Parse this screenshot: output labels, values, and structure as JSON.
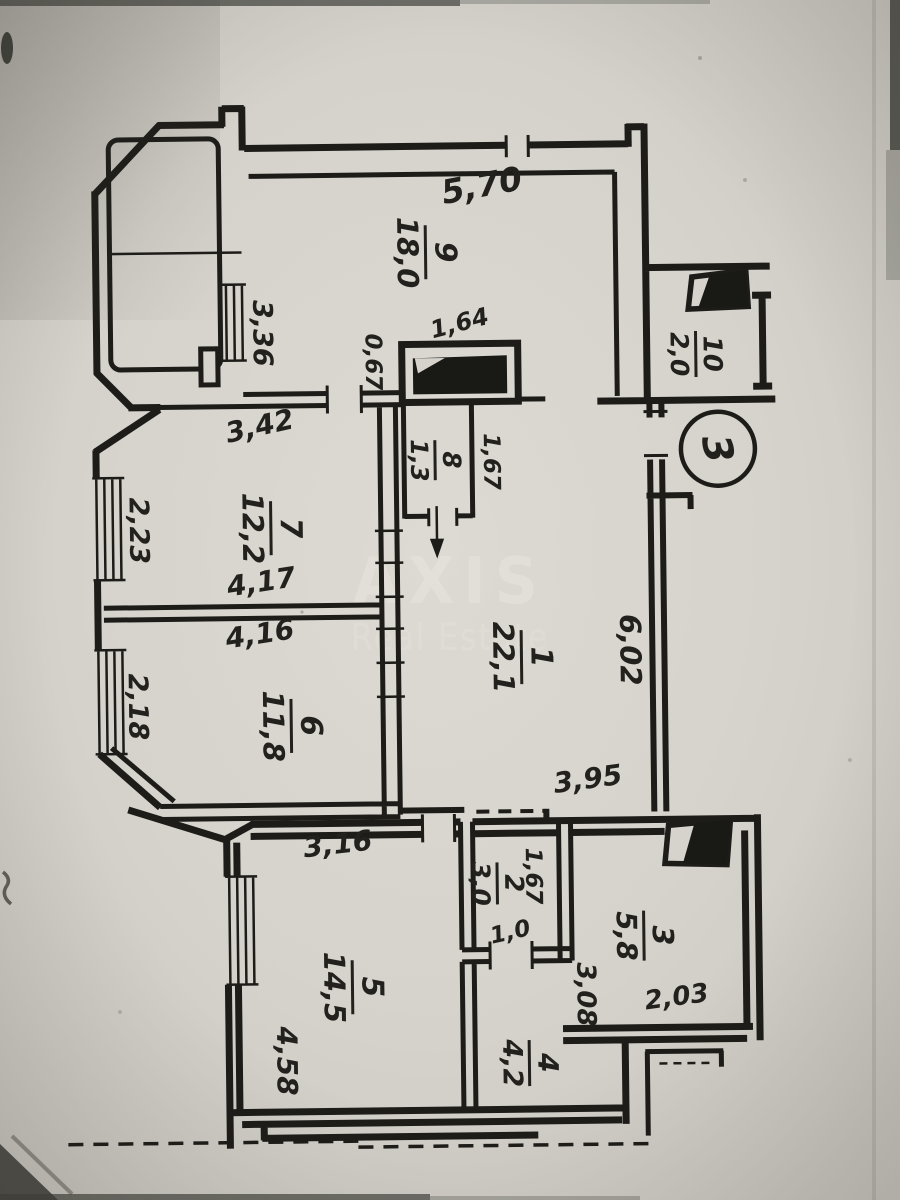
{
  "watermark": {
    "title": "AXIS",
    "subtitle": "Real Estate"
  },
  "section_marker": "3",
  "rooms": {
    "r1": {
      "number": "1",
      "area": "22,1"
    },
    "r2": {
      "number": "2",
      "area": "3,0"
    },
    "r3": {
      "number": "3",
      "area": "5,8"
    },
    "r4": {
      "number": "4",
      "area": "4,2"
    },
    "r5": {
      "number": "5",
      "area": "14,5"
    },
    "r6": {
      "number": "6",
      "area": "11,8"
    },
    "r7": {
      "number": "7",
      "area": "12,2"
    },
    "r8": {
      "number": "8",
      "area": "1,3"
    },
    "r9": {
      "number": "9",
      "area": "18,0"
    },
    "r10": {
      "number": "10",
      "area": "2,0"
    }
  },
  "dims": {
    "room9_width": "5,70",
    "room9_left": "3,36",
    "closet_width": "1,64",
    "closet_depth": "0,67",
    "room8_height": "1,67",
    "room7_top": "3,42",
    "room7_left": "2,23",
    "room7_bottom": "4,17",
    "room6_top": "4,16",
    "room6_left": "2,18",
    "room1_height": "6,02",
    "room1_bottom": "3,95",
    "room5_top": "3,16",
    "room5_left": "4,58",
    "room2_top": "1,67",
    "room2_width": "1,0",
    "room3_left": "3,08",
    "room3_bottom": "2,03"
  }
}
